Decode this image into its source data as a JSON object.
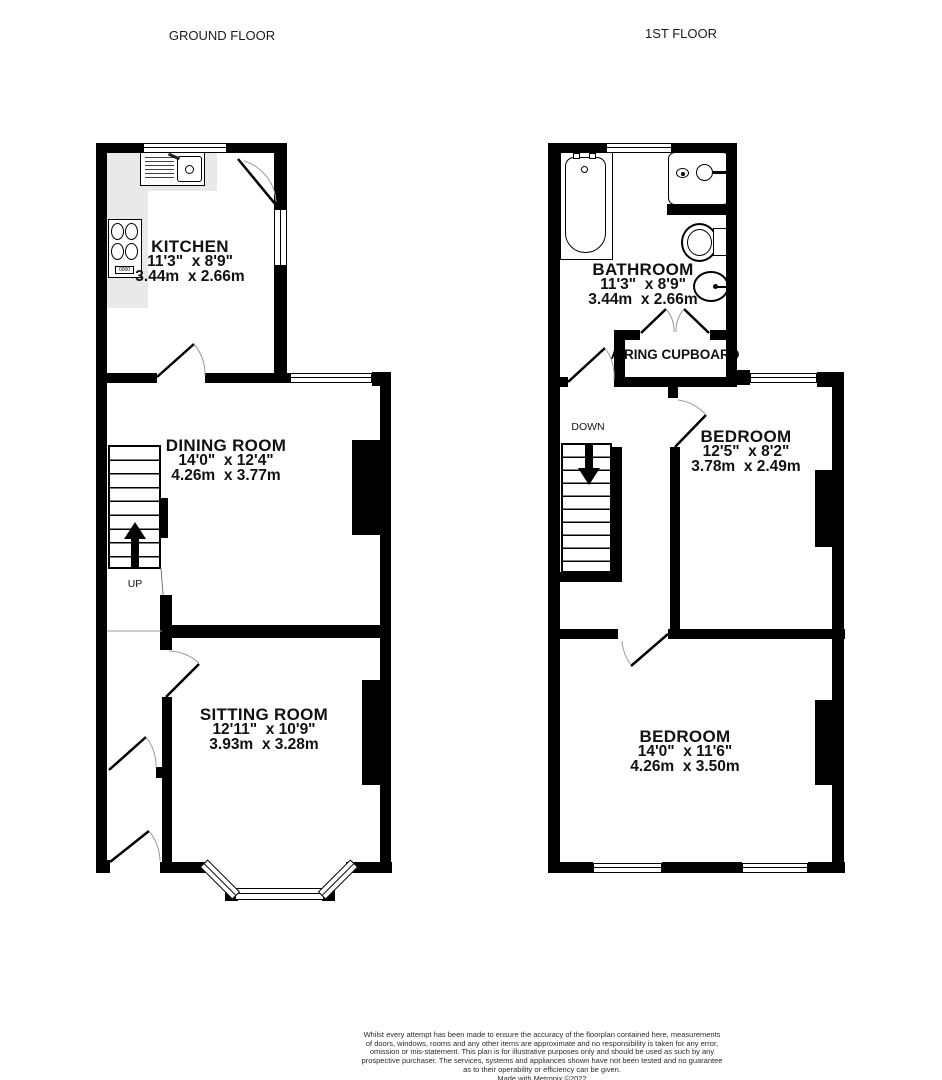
{
  "ground_floor": {
    "title": "GROUND FLOOR",
    "kitchen": {
      "name": "KITCHEN",
      "size_imperial": "11'3\"  x 8'9\"",
      "size_metric": "3.44m  x 2.66m"
    },
    "dining_room": {
      "name": "DINING ROOM",
      "size_imperial": "14'0\"  x 12'4\"",
      "size_metric": "4.26m  x 3.77m"
    },
    "sitting_room": {
      "name": "SITTING ROOM",
      "size_imperial": "12'11\"  x 10'9\"",
      "size_metric": "3.93m  x 3.28m"
    },
    "stairs_label": "UP",
    "hob_knobs": "0000"
  },
  "first_floor": {
    "title": "1ST FLOOR",
    "bathroom": {
      "name": "BATHROOM",
      "size_imperial": "11'3\"  x 8'9\"",
      "size_metric": "3.44m  x 2.66m"
    },
    "airing_cupboard": {
      "name": "AIRING CUPBOARD"
    },
    "bedroom_rear": {
      "name": "BEDROOM",
      "size_imperial": "12'5\"  x 8'2\"",
      "size_metric": "3.78m  x 2.49m"
    },
    "bedroom_front": {
      "name": "BEDROOM",
      "size_imperial": "14'0\"  x 11'6\"",
      "size_metric": "4.26m  x 3.50m"
    },
    "stairs_label": "DOWN"
  },
  "footer": {
    "lines": [
      "Whilst every attempt has been made to ensure the accuracy of the floorplan contained here, measurements",
      "of doors, windows, rooms and any other items are approximate and no responsibility is taken for any error,",
      "omission or mis-statement. This plan is for illustrative purposes only and should be used as such by any",
      "prospective purchaser. The services, systems and appliances shown have not been tested and no guarantee",
      "as to their operability or efficiency can be given.",
      "Made with Metropix ©2022"
    ]
  },
  "colors": {
    "wall": "#000000",
    "counter": "#e9e9e9",
    "text": "#111111",
    "swing_arc": "#9a9a9a"
  }
}
